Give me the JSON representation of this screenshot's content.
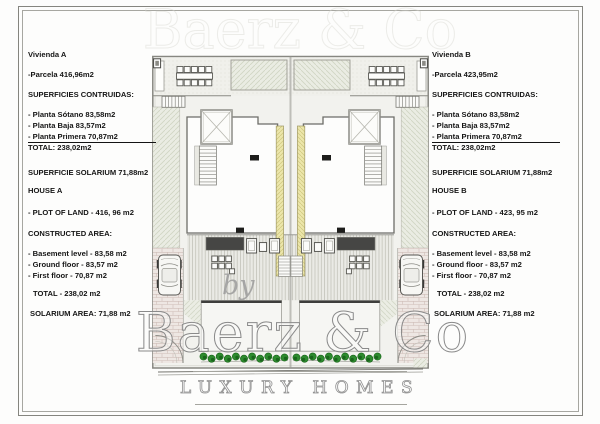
{
  "panel_a": {
    "lines": [
      "Vivienda A",
      "-Parcela 416,96m2",
      "SUPERFICIES CONTRUIDAS:",
      "- Planta Sótano 83,58m2",
      "- Planta Baja 83,57m2",
      "- Planta Primera 70,87m2",
      "TOTAL: 238,02m2",
      "SUPERFICIE SOLARIUM 71,88m2",
      "HOUSE A",
      "- PLOT OF LAND - 416, 96 m2",
      "CONSTRUCTED AREA:",
      "- Basement level - 83,58 m2",
      "- Ground floor - 83,57 m2",
      "- First floor - 70,87 m2",
      "TOTAL - 238,02 m2",
      "SOLARIUM AREA: 71,88 m2"
    ]
  },
  "panel_b": {
    "lines": [
      "Vivienda B",
      "-Parcela 423,95m2",
      "SUPERFICIES CONTRUIDAS:",
      "- Planta Sótano 83,58m2",
      "- Planta Baja 83,57m2",
      "- Planta Primera 70,87m2",
      "TOTAL: 238,02m2",
      "SUPERFICIE SOLARIUM 71,88m2",
      "HOUSE B",
      "- PLOT OF LAND - 423, 95 m2",
      "CONSTRUCTED AREA:",
      "- Basement level - 83,58 m2",
      "- Ground floor - 83,57 m2",
      "- First floor - 70,87 m2",
      "TOTAL - 238,02 m2",
      "SOLARIUM AREA: 71,88 m2"
    ]
  },
  "watermark": {
    "by": "by",
    "brand": "Baerz & Co",
    "tagline": "LUXURY HOMES"
  },
  "colors": {
    "plan_background": "#f2f2ee",
    "party_wall_yellow": "#ece6ab",
    "shrub_green": "#2e8b2f",
    "watermark_gray": "#9a9a9a",
    "text_color": "#151515"
  }
}
